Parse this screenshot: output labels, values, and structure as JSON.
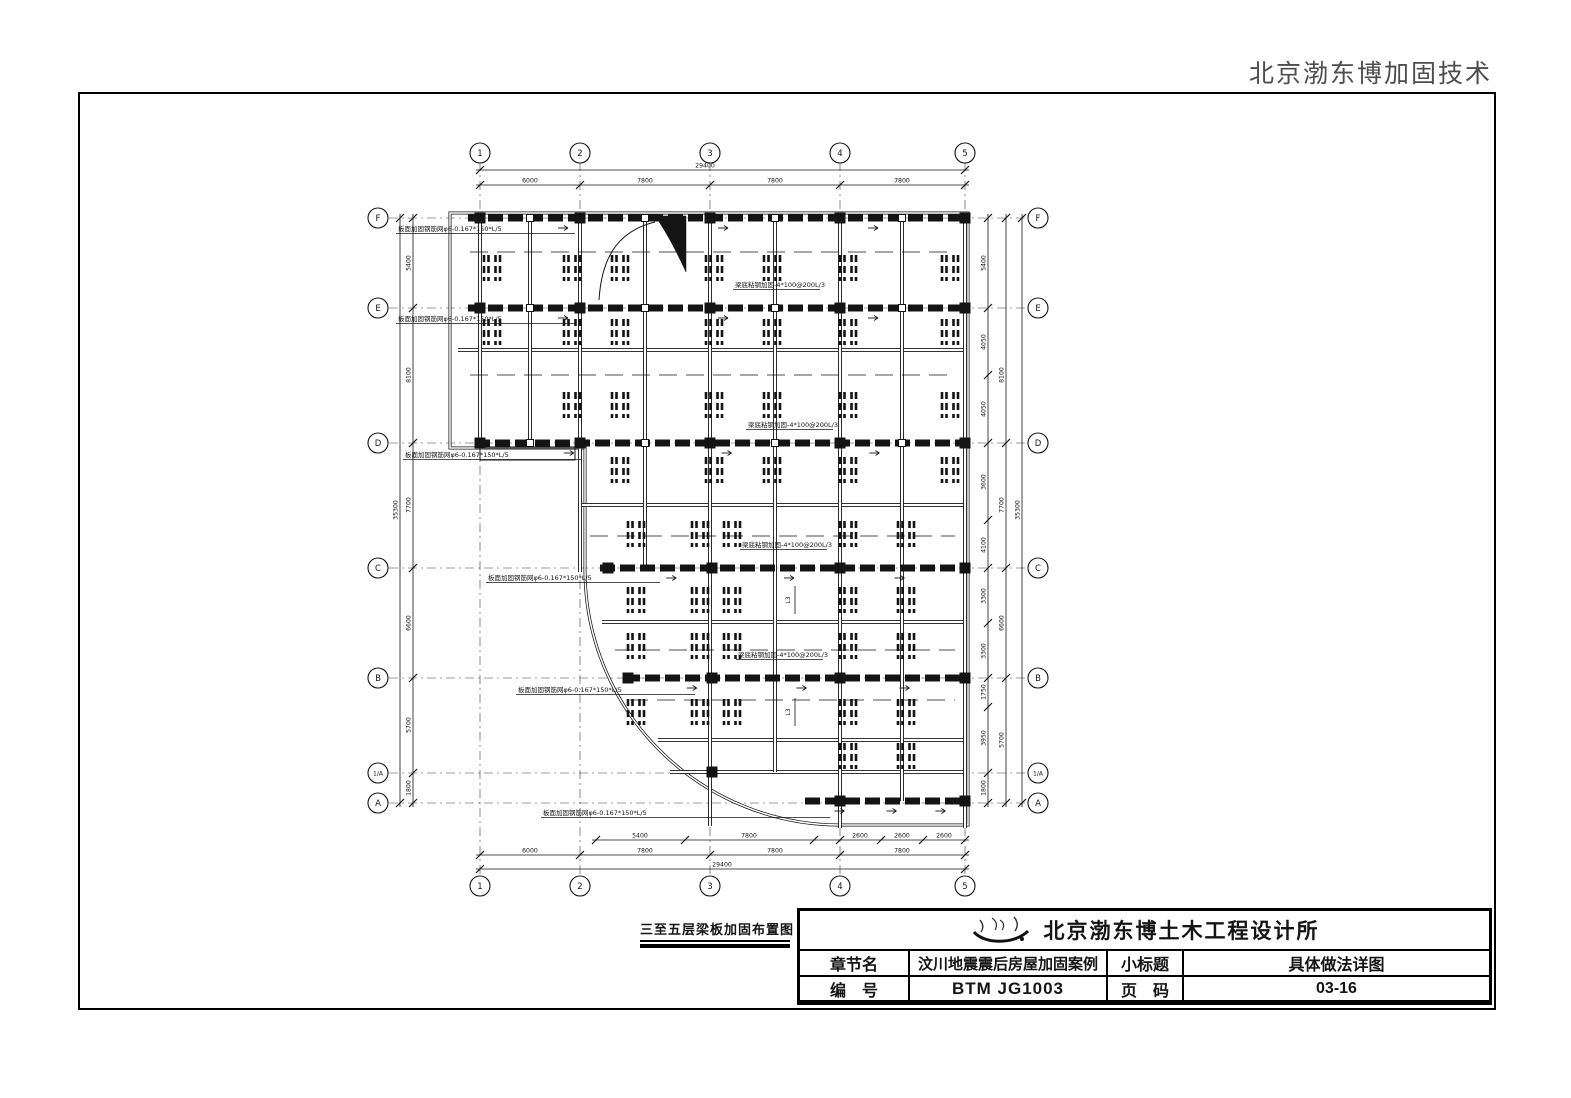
{
  "header": {
    "brand": "北京渤东博加固技术"
  },
  "figure": {
    "title": "三至五层梁板加固布置图"
  },
  "title_block": {
    "logo_icon": "calligraphy-signature-icon",
    "company": "北京渤东博土木工程设计所",
    "rows": [
      {
        "label": "章节名",
        "value": "汶川地震震后房屋加固案例",
        "label2": "小标题",
        "value2": "具体做法详图"
      },
      {
        "label": "编　号",
        "value": "BTM JG1003",
        "label2": "页　码",
        "value2": "03-16"
      }
    ]
  },
  "plan": {
    "stroke": "#141414",
    "grid": {
      "x1": 389,
      "x2": 1030,
      "y1": 162,
      "y2": 878
    },
    "cols": {
      "labels": [
        "1",
        "2",
        "3",
        "4",
        "5"
      ],
      "x": [
        480,
        580,
        710,
        840,
        965
      ],
      "bubble_y_top": 153,
      "bubble_y_bottom": 886
    },
    "rows": {
      "labels": [
        "F",
        "E",
        "D",
        "C",
        "B",
        "1/A",
        "A"
      ],
      "y": [
        218,
        308,
        443,
        568,
        678,
        773,
        803
      ],
      "bubble_x_left": 378,
      "bubble_x_right": 1038
    },
    "dims": {
      "horizontal": [
        {
          "y": 170,
          "ticks": [
            480,
            965
          ],
          "labels": [
            {
              "t": "29400",
              "x": 705
            }
          ]
        },
        {
          "y": 185,
          "ticks": [
            480,
            580,
            710,
            840,
            965
          ],
          "labels": [
            {
              "t": "6000",
              "x": 530
            },
            {
              "t": "7800",
              "x": 645
            },
            {
              "t": "7800",
              "x": 775
            },
            {
              "t": "7800",
              "x": 902
            }
          ]
        },
        {
          "y": 840,
          "ticks": [
            596,
            685,
            814,
            840,
            881,
            923,
            965
          ],
          "labels": [
            {
              "t": "5400",
              "x": 640
            },
            {
              "t": "7800",
              "x": 749
            },
            {
              "t": "2600",
              "x": 860
            },
            {
              "t": "2600",
              "x": 902
            },
            {
              "t": "2600",
              "x": 944
            }
          ]
        },
        {
          "y": 855,
          "ticks": [
            480,
            580,
            710,
            840,
            965
          ],
          "labels": [
            {
              "t": "6000",
              "x": 530
            },
            {
              "t": "7800",
              "x": 645
            },
            {
              "t": "7800",
              "x": 775
            },
            {
              "t": "7800",
              "x": 902
            }
          ]
        },
        {
          "y": 869,
          "ticks": [
            480,
            965
          ],
          "labels": [
            {
              "t": "29400",
              "x": 722
            }
          ]
        }
      ],
      "vertical": [
        {
          "x": 413,
          "ticks": [
            218,
            308,
            443,
            568,
            678,
            773,
            803
          ],
          "labels": [
            {
              "t": "5400",
              "y": 263
            },
            {
              "t": "8100",
              "y": 375
            },
            {
              "t": "7700",
              "y": 505
            },
            {
              "t": "6600",
              "y": 623
            },
            {
              "t": "5700",
              "y": 725
            },
            {
              "t": "1800",
              "y": 788
            }
          ]
        },
        {
          "x": 400,
          "ticks": [
            218,
            803
          ],
          "labels": [
            {
              "t": "35300",
              "y": 510
            }
          ]
        },
        {
          "x": 988,
          "ticks": [
            218,
            308,
            375,
            443,
            520,
            568,
            623,
            678,
            707,
            773,
            803
          ],
          "labels": [
            {
              "t": "5400",
              "y": 263
            },
            {
              "t": "4050",
              "y": 342
            },
            {
              "t": "4050",
              "y": 409
            },
            {
              "t": "3600",
              "y": 482
            },
            {
              "t": "4100",
              "y": 545
            },
            {
              "t": "3300",
              "y": 596
            },
            {
              "t": "3300",
              "y": 651
            },
            {
              "t": "1750",
              "y": 692
            },
            {
              "t": "3950",
              "y": 738
            },
            {
              "t": "1800",
              "y": 788
            }
          ]
        },
        {
          "x": 1006,
          "ticks": [
            218,
            443,
            568,
            678,
            803
          ],
          "labels": [
            {
              "t": "8100",
              "y": 375
            },
            {
              "t": "7700",
              "y": 505
            },
            {
              "t": "6600",
              "y": 623
            },
            {
              "t": "5700",
              "y": 740
            }
          ]
        },
        {
          "x": 1022,
          "ticks": [
            218,
            803
          ],
          "labels": [
            {
              "t": "35300",
              "y": 510
            }
          ]
        }
      ]
    },
    "outline": {
      "main": "M450,213 H968 V825 H840 A255 255 0 0 1 585,570 V448 H450 Z",
      "step": "M480,448 h95 v12 h-95 z"
    },
    "heavy_beams": [
      {
        "y": 218,
        "x1": 468,
        "x2": 968
      },
      {
        "y": 308,
        "x1": 468,
        "x2": 968
      },
      {
        "y": 443,
        "x1": 475,
        "x2": 968
      },
      {
        "y": 568,
        "x1": 600,
        "x2": 968
      },
      {
        "y": 678,
        "x1": 625,
        "x2": 968
      },
      {
        "y": 801,
        "x1": 805,
        "x2": 968
      }
    ],
    "v_beams": [
      {
        "x": 480,
        "y1": 213,
        "y2": 448
      },
      {
        "x": 580,
        "y1": 213,
        "y2": 572
      },
      {
        "x": 710,
        "y1": 213,
        "y2": 826
      },
      {
        "x": 840,
        "y1": 213,
        "y2": 828
      },
      {
        "x": 965,
        "y1": 213,
        "y2": 828
      },
      {
        "x": 530,
        "y1": 218,
        "y2": 443
      },
      {
        "x": 645,
        "y1": 218,
        "y2": 443
      },
      {
        "x": 775,
        "y1": 218,
        "y2": 443
      },
      {
        "x": 902,
        "y1": 218,
        "y2": 443
      },
      {
        "x": 645,
        "y1": 443,
        "y2": 568
      },
      {
        "x": 775,
        "y1": 443,
        "y2": 772
      },
      {
        "x": 902,
        "y1": 443,
        "y2": 801
      }
    ],
    "h_beams": [
      {
        "y": 350,
        "x1": 458,
        "x2": 965
      },
      {
        "y": 505,
        "x1": 580,
        "x2": 965
      },
      {
        "y": 622,
        "x1": 602,
        "x2": 965
      },
      {
        "y": 740,
        "x1": 658,
        "x2": 965
      },
      {
        "y": 772,
        "x1": 670,
        "x2": 965
      }
    ],
    "strip_lines": [
      {
        "y": 252,
        "x1": 470,
        "x2": 955
      },
      {
        "y": 375,
        "x1": 470,
        "x2": 955
      },
      {
        "y": 536,
        "x1": 590,
        "x2": 955
      },
      {
        "y": 650,
        "x1": 615,
        "x2": 955
      },
      {
        "y": 700,
        "x1": 630,
        "x2": 955
      }
    ],
    "squares": {
      "size": 11,
      "pts": [
        [
          480,
          218
        ],
        [
          580,
          218
        ],
        [
          710,
          218
        ],
        [
          840,
          218
        ],
        [
          965,
          218
        ],
        [
          480,
          308
        ],
        [
          580,
          308
        ],
        [
          710,
          308
        ],
        [
          840,
          308
        ],
        [
          965,
          308
        ],
        [
          480,
          443
        ],
        [
          580,
          443
        ],
        [
          710,
          443
        ],
        [
          840,
          443
        ],
        [
          965,
          443
        ],
        [
          608,
          568
        ],
        [
          712,
          568
        ],
        [
          840,
          568
        ],
        [
          965,
          568
        ],
        [
          628,
          678
        ],
        [
          712,
          678
        ],
        [
          840,
          678
        ],
        [
          965,
          678
        ],
        [
          840,
          801
        ],
        [
          965,
          801
        ],
        [
          712,
          772
        ]
      ]
    },
    "anchors": {
      "size": 7,
      "pts": [
        [
          530,
          218
        ],
        [
          645,
          218
        ],
        [
          775,
          218
        ],
        [
          902,
          218
        ],
        [
          530,
          308
        ],
        [
          645,
          308
        ],
        [
          775,
          308
        ],
        [
          902,
          308
        ],
        [
          530,
          443
        ],
        [
          645,
          443
        ],
        [
          775,
          443
        ],
        [
          902,
          443
        ]
      ]
    },
    "cluster_rows": [
      {
        "y": 268,
        "xs": [
          492,
          572,
          620,
          714,
          772,
          848,
          950
        ]
      },
      {
        "y": 332,
        "xs": [
          492,
          572,
          620,
          714,
          772,
          848,
          950
        ]
      },
      {
        "y": 405,
        "xs": [
          572,
          620,
          714,
          772,
          848,
          950
        ]
      },
      {
        "y": 470,
        "xs": [
          620,
          714,
          772,
          848,
          950
        ]
      },
      {
        "y": 534,
        "xs": [
          636,
          700,
          732,
          848,
          906
        ]
      },
      {
        "y": 600,
        "xs": [
          636,
          700,
          732,
          848,
          906
        ]
      },
      {
        "y": 646,
        "xs": [
          636,
          700,
          732,
          848,
          906
        ]
      },
      {
        "y": 712,
        "xs": [
          636,
          700,
          732,
          848,
          906
        ]
      },
      {
        "y": 756,
        "xs": [
          848,
          906
        ]
      }
    ],
    "annotations": [
      {
        "t": "板面加固钢筋网φ6-0.167*150*L/5",
        "x": 398,
        "y": 231,
        "x2": 575
      },
      {
        "t": "板面加固钢筋网φ6-0.167*150*L/5",
        "x": 398,
        "y": 321,
        "x2": 575
      },
      {
        "t": "板面加固钢筋网φ6-0.167*150*L/5",
        "x": 405,
        "y": 457,
        "x2": 582
      },
      {
        "t": "板面加固钢筋网φ6-0.167*150*L/5",
        "x": 488,
        "y": 580,
        "x2": 660
      },
      {
        "t": "板面加固钢筋网φ6-0.167*150*L/5",
        "x": 518,
        "y": 692,
        "x2": 695
      },
      {
        "t": "板面加固钢筋网φ6-0.167*150*L/5",
        "x": 543,
        "y": 815,
        "x2": 830
      },
      {
        "t": "梁底粘钢加固-4*100@200L/3",
        "x": 735,
        "y": 287,
        "x2": 820
      },
      {
        "t": "梁底粘钢加固-4*100@200L/3",
        "x": 748,
        "y": 427,
        "x2": 833
      },
      {
        "t": "梁底粘钢加固-4*100@200L/3",
        "x": 742,
        "y": 547,
        "x2": 827
      },
      {
        "t": "梁底粘钢加固-4*100@200L/3",
        "x": 738,
        "y": 657,
        "x2": 823
      }
    ],
    "sub_labels": [
      {
        "t": "L3",
        "x": 790,
        "y": 600
      },
      {
        "t": "L3",
        "x": 790,
        "y": 712
      }
    ],
    "wedge": {
      "fill": "M655,216 L686,216 L686,272 C673,244 663,227 655,216 Z",
      "curve": "M599,300 C602,252 622,230 655,222"
    }
  }
}
